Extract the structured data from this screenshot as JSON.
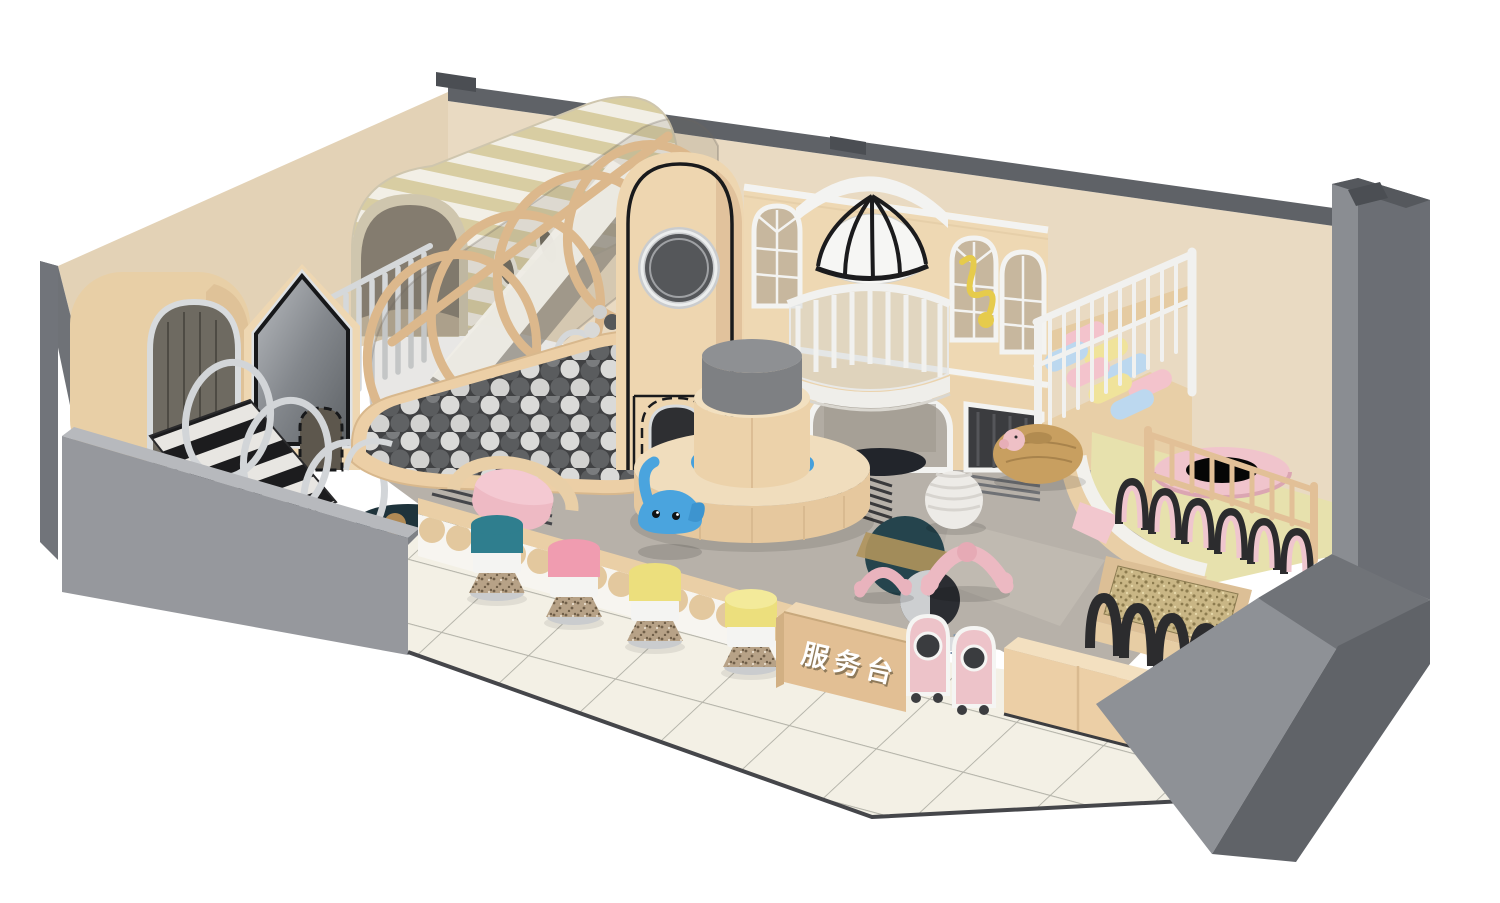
{
  "scene": {
    "sign": {
      "label": "服务台"
    },
    "palette": {
      "background": "#ffffff",
      "wall_top_gray": "#5f6267",
      "wall_beige": "#e9dac2",
      "left_wall_beige": "#e3d2b6",
      "outer_gray": "#96989d",
      "outer_gray_light": "#b7b9bd",
      "pillar_gray": "#6b6e74",
      "structure_beige": "#ecd3ac",
      "structure_beige_shadow": "#dfc09c",
      "stripe_tan": "#d8cda2",
      "stripe_white": "#f2efe6",
      "silver": "#d2d5d8",
      "ball_dark": "#4a4b4d",
      "ball_light": "#dcdcda",
      "accent_pink": "#f0c4cc",
      "accent_blue": "#4aa4de",
      "dome_white": "#f6f6f4",
      "dome_rib_black": "#1c1c1c",
      "platform_yellow": "#e7e1ad",
      "sand": "#c9b685",
      "fence_black": "#2c2c2e",
      "rug_gray": "#b7b1a9",
      "rug_teal": "#25444d",
      "rug_tan": "#b0955c",
      "floor_tile": "#f3f0e5",
      "desk_beige": "#e2bf94",
      "stool_teal": "#2f7e8e",
      "stool_pink": "#f09cb0",
      "stool_yellow": "#ecdf7d",
      "beanbag_tan": "#c89f60"
    }
  }
}
